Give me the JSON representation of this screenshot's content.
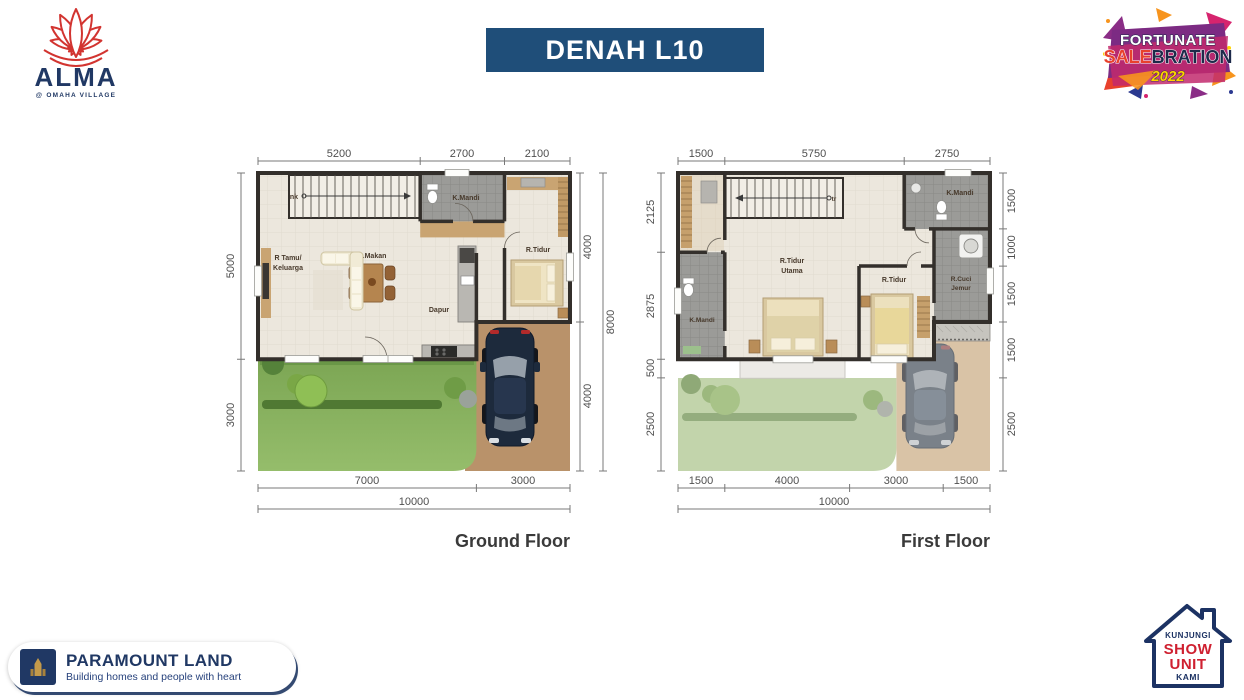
{
  "title": "DENAH L10",
  "logo": {
    "brand": "ALMA",
    "subtitle": "@ OMAHA VILLAGE"
  },
  "event_badge": {
    "line1": "FORTUNATE",
    "sale": "SALE",
    "bration": "BRATION",
    "year": "2022"
  },
  "ground_floor": {
    "name": "Ground Floor",
    "dims_top": [
      "5200",
      "2700",
      "2100"
    ],
    "dims_left": [
      "5000",
      "3000"
    ],
    "dims_right_inner": [
      "4000",
      "4000"
    ],
    "dims_right_outer": "8000",
    "dims_bottom": [
      "7000",
      "3000"
    ],
    "dims_bottom_total": "10000",
    "labels": {
      "stairs": "nk",
      "bathroom": "K.Mandi",
      "dining": "R.Makan",
      "living1": "R Tamu/",
      "living2": "Keluarga",
      "bedroom": "R.Tidur",
      "kitchen": "Dapur"
    }
  },
  "first_floor": {
    "name": "First Floor",
    "dims_top": [
      "1500",
      "5750",
      "2750"
    ],
    "dims_left": [
      "2125",
      "2875",
      "500",
      "2500"
    ],
    "dims_right": [
      "1500",
      "1000",
      "1500",
      "1500",
      "2500"
    ],
    "dims_bottom": [
      "1500",
      "4000",
      "3000",
      "1500"
    ],
    "dims_bottom_total": "10000",
    "labels": {
      "stairs": "tr",
      "bathroom_top": "K.Mandi",
      "master1": "R.Tidur",
      "master2": "Utama",
      "bathroom_left": "K.Mandi",
      "bedroom": "R.Tidur",
      "laundry1": "R.Cuci",
      "laundry2": "Jemur"
    }
  },
  "footer": {
    "brand": "PARAMOUNT LAND",
    "tagline": "Building homes and people with heart"
  },
  "visit_badge": {
    "line1": "KUNJUNGI",
    "line2": "SHOW",
    "line3": "UNIT",
    "line4": "KAMI"
  },
  "colors": {
    "banner_navy": "#1F4E79",
    "brand_navy": "#203864",
    "accent_red": "#D6232A",
    "wall_dark": "#332F2B",
    "grass_green": "#7CA654",
    "driveway_brown": "#B9926A"
  }
}
